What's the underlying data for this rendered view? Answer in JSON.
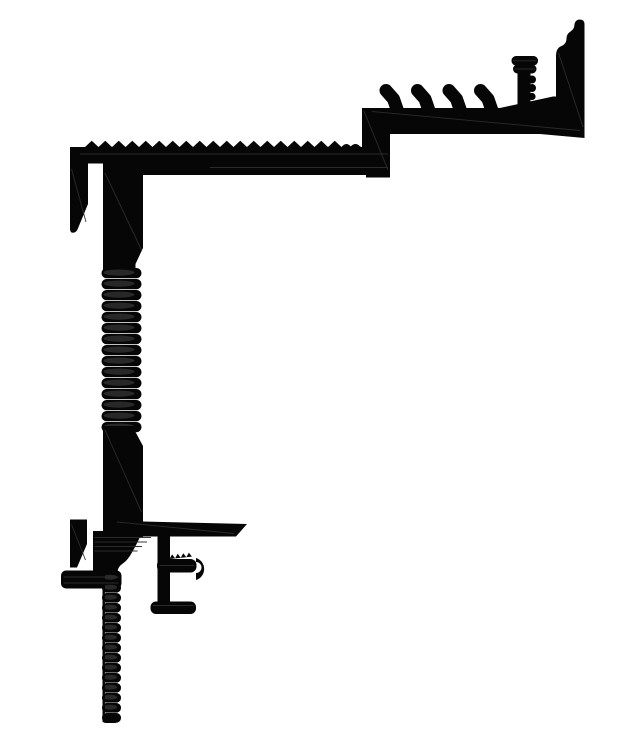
{
  "canvas": {
    "width": 631,
    "height": 732,
    "background": "#ffffff"
  },
  "drawing": {
    "kind": "technical cross-section silhouette",
    "subject": "aluminium extrusion edge profile, black filled CAD cross-section on white",
    "colors": {
      "ink": "#060606",
      "rib_highlight": "#282828",
      "hairline": "#2e2e2e",
      "background": "#ffffff"
    },
    "parts": [
      {
        "id": "upper-shelf-assembly",
        "features": [
          "stepped end wall with knurled crest",
          "four barbed retention fins",
          "ribbed stud with double-collar head",
          "sloped shelf into end wall"
        ]
      },
      {
        "id": "serrated-top-rail",
        "features": [
          "saw-tooth anti-slip serrations on top face",
          "down-turned hook at left end",
          "riser step up to shelf at right end"
        ]
      },
      {
        "id": "vertical-web",
        "features": [
          "plain upper section",
          "threaded ribbed mid section",
          "plain lower section"
        ]
      },
      {
        "id": "lower-bracket-assembly",
        "features": [
          "tapered horizontal support arm",
          "left edge hook with rounded foot pad",
          "ribbed tapering transition",
          "clip stem with serrated tab and curled lip",
          "clip base pad",
          "long serrated anchor strip"
        ]
      }
    ]
  }
}
